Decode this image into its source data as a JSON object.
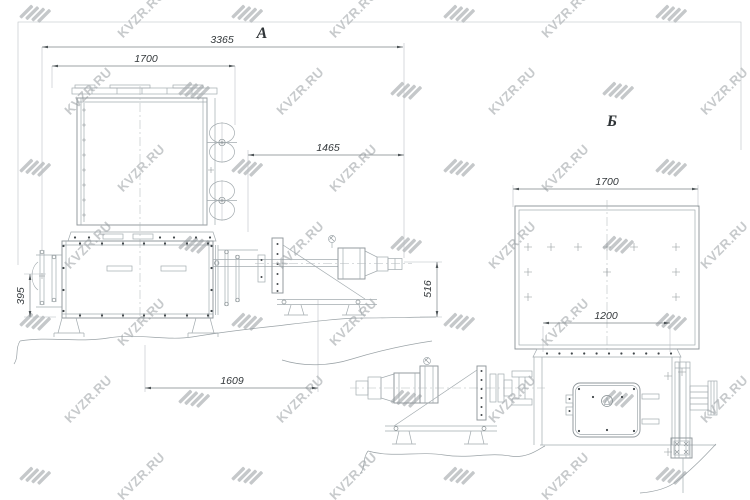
{
  "watermark": {
    "text": "KVZR.RU"
  },
  "drawing": {
    "view_a": {
      "label": "А",
      "dims": {
        "overall_length": "3365",
        "top_width": "1700",
        "drive_span": "1465",
        "left_height": "395",
        "base_span": "1609",
        "drive_height": "516"
      }
    },
    "view_b": {
      "label": "Б",
      "dims": {
        "top_width": "1700",
        "bottom_span": "1200"
      }
    }
  }
}
